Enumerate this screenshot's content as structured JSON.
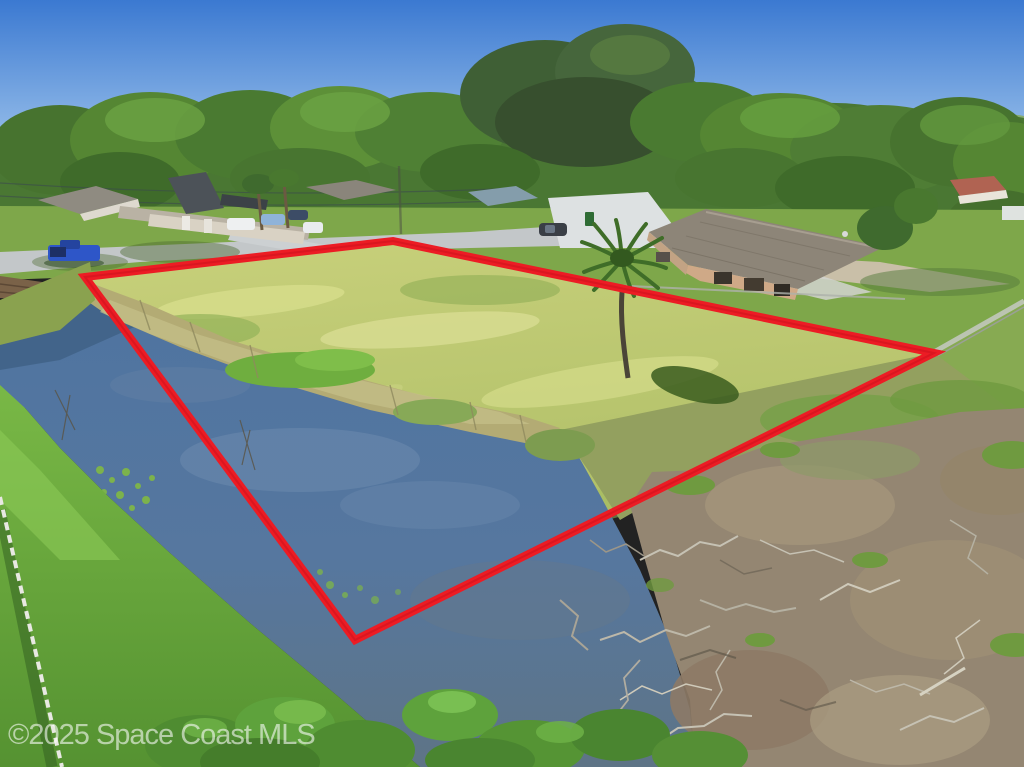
{
  "watermark": {
    "text": "©2025 Space Coast MLS"
  },
  "boundary": {
    "points": "85,277 393,241 934,353 355,640",
    "vertices": {
      "west": [
        85,
        277
      ],
      "north": [
        393,
        241
      ],
      "east": [
        934,
        353
      ],
      "south": [
        355,
        640
      ]
    }
  },
  "colors": {
    "boundary_red": "#ec1c24",
    "sky_top": "#3b79d1",
    "sky_horizon": "#b9d8f3",
    "water_top": "#4f74a0",
    "water_bottom": "#5e7486",
    "lot_grass_top": "#c8d07b",
    "lot_grass_bottom": "#a9bb62",
    "bank_grass": "#6fae3d",
    "tree_green": "#4a7733",
    "scrub_tan": "#948672",
    "road_gray": "#c3c7c9",
    "truck_blue": "#2e56c8"
  }
}
